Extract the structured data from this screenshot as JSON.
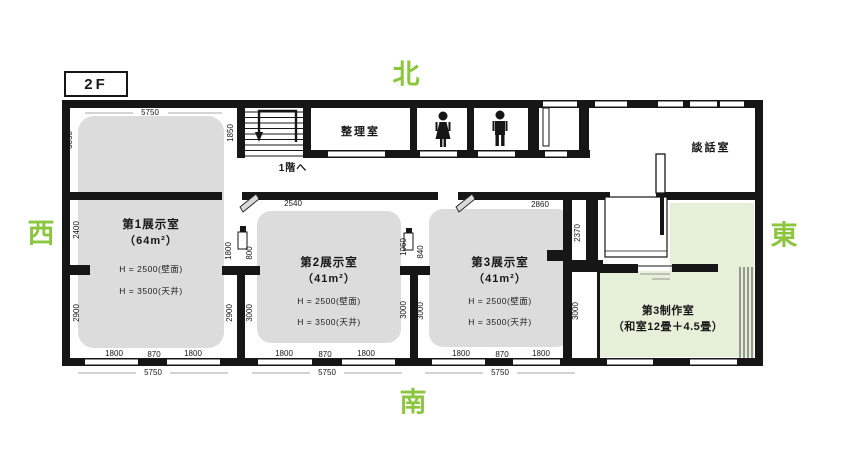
{
  "floor": {
    "label": "2F"
  },
  "compass": {
    "north": "北",
    "south": "南",
    "west": "西",
    "east": "東"
  },
  "stairs": {
    "to_first_floor": "1階へ"
  },
  "rooms": {
    "exhibit1": {
      "name": "第1展示室",
      "area": "（64m²）",
      "wall_height": "H = 2500(壁面)",
      "ceiling_height": "H = 3500(天井)"
    },
    "exhibit2": {
      "name": "第2展示室",
      "area": "（41m²）",
      "wall_height": "H = 2500(壁面)",
      "ceiling_height": "H = 3500(天井)"
    },
    "exhibit3": {
      "name": "第3展示室",
      "area": "（41m²）",
      "wall_height": "H = 2500(壁面)",
      "ceiling_height": "H = 3500(天井)"
    },
    "sorting": {
      "name": "整理室"
    },
    "lounge": {
      "name": "談話室"
    },
    "studio3": {
      "name": "第3制作室",
      "detail": "（和室12畳＋4.5畳）"
    }
  },
  "icons": {
    "woman_restroom": "woman-icon",
    "man_restroom": "man-icon",
    "stairs": "stairs-icon"
  },
  "colors": {
    "accent_green": "#8CC63F",
    "exhibit_room_fill": "#DCDCDC",
    "tatami_room_fill": "#E6EFD8",
    "wall": "#161616"
  },
  "dimensions": [
    {
      "t": "5750",
      "x": 150,
      "y": 113
    },
    {
      "t": "1850",
      "x": 231,
      "y": 133,
      "v": true
    },
    {
      "t": "3050",
      "x": 70,
      "y": 140,
      "v": true
    },
    {
      "t": "2540",
      "x": 293,
      "y": 204
    },
    {
      "t": "2860",
      "x": 540,
      "y": 205
    },
    {
      "t": "2400",
      "x": 77,
      "y": 230,
      "v": true
    },
    {
      "t": "2900",
      "x": 77,
      "y": 313,
      "v": true
    },
    {
      "t": "1800",
      "x": 229,
      "y": 251,
      "v": true
    },
    {
      "t": "800",
      "x": 250,
      "y": 253,
      "v": true
    },
    {
      "t": "2900",
      "x": 230,
      "y": 313,
      "v": true
    },
    {
      "t": "3000",
      "x": 250,
      "y": 313,
      "v": true
    },
    {
      "t": "1060",
      "x": 404,
      "y": 247,
      "v": true
    },
    {
      "t": "840",
      "x": 421,
      "y": 252,
      "v": true
    },
    {
      "t": "3000",
      "x": 404,
      "y": 310,
      "v": true
    },
    {
      "t": "3000",
      "x": 421,
      "y": 311,
      "v": true
    },
    {
      "t": "2370",
      "x": 578,
      "y": 233,
      "v": true
    },
    {
      "t": "3000",
      "x": 576,
      "y": 311,
      "v": true
    },
    {
      "t": "1800",
      "x": 114,
      "y": 354
    },
    {
      "t": "870",
      "x": 154,
      "y": 355
    },
    {
      "t": "1800",
      "x": 193,
      "y": 354
    },
    {
      "t": "5750",
      "x": 153,
      "y": 373
    },
    {
      "t": "1800",
      "x": 284,
      "y": 354
    },
    {
      "t": "870",
      "x": 325,
      "y": 355
    },
    {
      "t": "1800",
      "x": 366,
      "y": 354
    },
    {
      "t": "5750",
      "x": 327,
      "y": 373
    },
    {
      "t": "1800",
      "x": 461,
      "y": 354
    },
    {
      "t": "870",
      "x": 502,
      "y": 355
    },
    {
      "t": "1800",
      "x": 541,
      "y": 354
    },
    {
      "t": "5750",
      "x": 500,
      "y": 373
    }
  ]
}
